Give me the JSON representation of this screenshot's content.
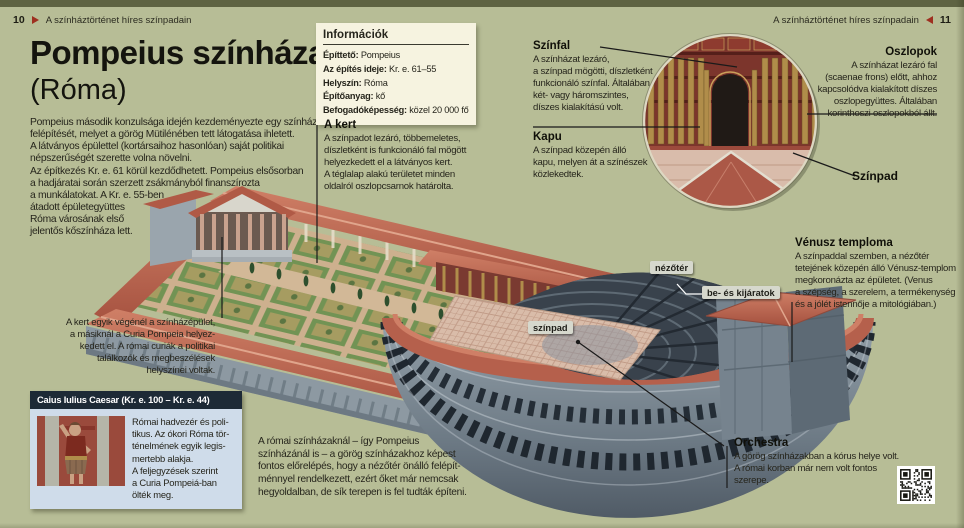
{
  "header": {
    "left": {
      "page_number": "10",
      "title": "A színháztörténet híres színpadain"
    },
    "right": {
      "page_number": "11",
      "title": "A színháztörténet híres színpadain"
    }
  },
  "title": {
    "line1": "Pompeius színháza",
    "line2": "(Róma)"
  },
  "intro": {
    "p1": "Pompeius második konzulsága idején kezdeményezte egy színház\nfelépítését, melyet a görög Mütilénében tett látogatása ihletett.\nA látványos épülettel (kortársaihoz hasonlóan) saját politikai\nnépszerűségét szerette volna növelni.",
    "p2": "Az építkezés Kr. e. 61 körül kezdődhetett. Pompeius elsősorban\na hadjáratai során szerzett zsákmányból finanszírozta\na munkálatokat. A Kr. e. 55-ben\nátadott épületegyüttes\nRóma városának első\njelentős kőszínháza lett."
  },
  "info_box": {
    "title": "Információk",
    "rows": [
      {
        "label": "Építtető:",
        "value": "Pompeius"
      },
      {
        "label": "Az építés ideje:",
        "value": "Kr. e. 61–55"
      },
      {
        "label": "Helyszín:",
        "value": "Róma"
      },
      {
        "label": "Építőanyag:",
        "value": "kő"
      },
      {
        "label": "Befogadóképesség:",
        "value": "közel 20 000 fő"
      }
    ]
  },
  "callouts": {
    "kert": {
      "title": "A kert",
      "body": "A színpadot lezáró, többemeletes,\ndíszletként is funkcionáló fal mögött\nhelyezkedett el a látványos kert.\nA téglalap alakú területet minden\noldalról oszlopcsarnok határolta."
    },
    "szinfal": {
      "title": "Színfal",
      "body": "A színházat lezáró,\na színpad mögötti, díszletként\nfunkcionáló színfal. Általában\nkét- vagy háromszintes,\ndíszes kialakítású volt."
    },
    "kapu": {
      "title": "Kapu",
      "body": "A színpad közepén álló\nkapu, melyen át a színészek\nközlekedtek."
    },
    "oszlopok": {
      "title": "Oszlopok",
      "body": "A színházat lezáró fal\n(scaenae frons) előtt, ahhoz\nkapcsolódva kialakított díszes\noszlopegyüttes. Általában\nkorinthoszi oszlopokból állt."
    },
    "szinpad": {
      "title": "Színpad"
    },
    "venusz": {
      "title": "Vénusz temploma",
      "body": "A színpaddal szemben, a nézőtér\ntetejének közepén álló Vénusz-templom\nmegkoronázta az épületet. (Venus\na szépség, a szerelem, a termékenység\nés a jólét istennője a mitológiában.)"
    },
    "orchestra": {
      "title": "Orchestra",
      "body": "A görög színházakban a kórus helye volt.\nA római korban már nem volt fontos\nszerepe."
    }
  },
  "notes": {
    "kert_vege": "A kert egyik végénél a színházépület,\na másiknál a Curia Pompeia helyez-\nkedett el. A római curiák a politikai\ntalálkozók és megbeszélések\nhelyszínei voltak.",
    "romai_szinhazak": "A római színházaknál – így Pompeius\nszínházánál is – a görög színházakhoz képest\nfontos előrelépés, hogy a nézőtér önálló felépít-\nménnyel rendelkezett, ezért őket már nemcsak\nhegyoldalban, de sík terepen is fel tudták építeni."
  },
  "diagram_tags": {
    "nezoter": "nézőtér",
    "be_es_kijaratok": "be- és kijáratok",
    "szinpad": "színpad"
  },
  "caesar_box": {
    "title": "Caius Iulius Caesar (Kr. e. 100 – Kr. e. 44)",
    "body": "Római hadvezér és poli-\ntikus. Az ókori Róma tör-\nténelmének egyik legis-\nmertebb alakja.\nA feljegyzések szerint\na Curia Pompeiá-ban\nölték meg."
  },
  "icons": {
    "page_arrow_right": "triangle-right",
    "page_arrow_left": "triangle-left",
    "qr_code": "qr-code"
  },
  "colors": {
    "page_background": "#b7bd96",
    "top_strip": "#5e6342",
    "accent_red": "#9e2f20",
    "info_box_background": "#f6f3e0",
    "caesar_header_background": "#1d2a36",
    "caesar_body_background": "#cfdcea",
    "label_tag_background": "#d6d8cd",
    "roof_red": "#b5604c",
    "stone_gray": "#7c8994",
    "garden_green": "#6d9150",
    "inset_wall_maroon": "#7c352c",
    "column_gold": "#b08d4a"
  }
}
